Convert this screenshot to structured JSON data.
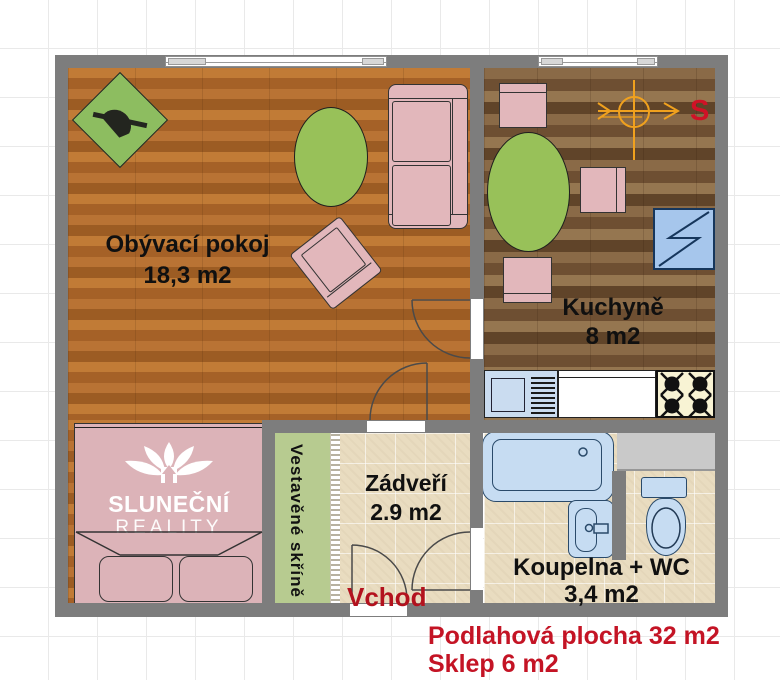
{
  "compass": {
    "label": "S"
  },
  "rooms": {
    "living": {
      "name": "Obývací pokoj",
      "area": "18,3 m2"
    },
    "kitchen": {
      "name": "Kuchyně",
      "area": "8 m2"
    },
    "hall": {
      "name": "Zádveří",
      "area": "2.9 m2"
    },
    "bathroom": {
      "name": "Koupelna + WC",
      "area": "3,4 m2"
    },
    "wardrobe": {
      "name": "Vestavěné skříně"
    }
  },
  "labels": {
    "entrance": "Vchod"
  },
  "footer": {
    "total_area": "Podlahová plocha 32 m2",
    "cellar": "Sklep 6 m2"
  },
  "watermark": {
    "brand_line1": "SLUNEČNÍ",
    "brand_line2": "REALITY"
  },
  "colors": {
    "wall": "#7d7d7d",
    "red_text": "#c41425",
    "living_floor": "#b06c2c",
    "kitchen_floor": "#7e5e3e",
    "tile_floor": "#e9dcc0",
    "furniture_pink": "#e2b7bb",
    "table_green": "#98c159",
    "rug_green": "#8dbd60",
    "wardrobe_green": "#b7cb90",
    "fixture_blue": "#c6dcf2",
    "compass_orange": "#f0a11e"
  }
}
